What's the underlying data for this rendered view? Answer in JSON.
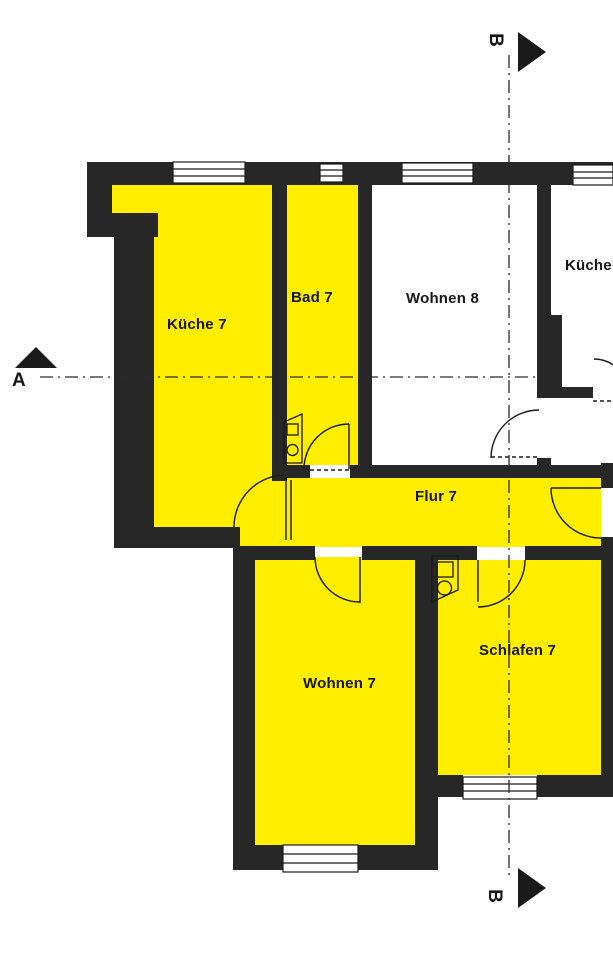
{
  "document": {
    "type": "floor-plan",
    "description": "Apartment floor plan with highlighted rooms of unit 7"
  },
  "rooms": {
    "kueche7": {
      "label": "Küche 7",
      "highlighted": true
    },
    "bad7": {
      "label": "Bad 7",
      "highlighted": true
    },
    "wohnen8": {
      "label": "Wohnen 8",
      "highlighted": false
    },
    "kueche8": {
      "label": "Küche",
      "highlighted": false
    },
    "flur7": {
      "label": "Flur 7",
      "highlighted": true
    },
    "wohnen7": {
      "label": "Wohnen 7",
      "highlighted": true
    },
    "schlafen7": {
      "label": "Schlafen 7",
      "highlighted": true
    }
  },
  "section_markers": {
    "a": {
      "label": "A"
    },
    "b_top": {
      "label": "B"
    },
    "b_bottom": {
      "label": "B"
    }
  },
  "colors": {
    "room_highlight": "#ffee00",
    "wall": "#272727",
    "line": "#1a1a1a",
    "bg": "#ffffff"
  }
}
